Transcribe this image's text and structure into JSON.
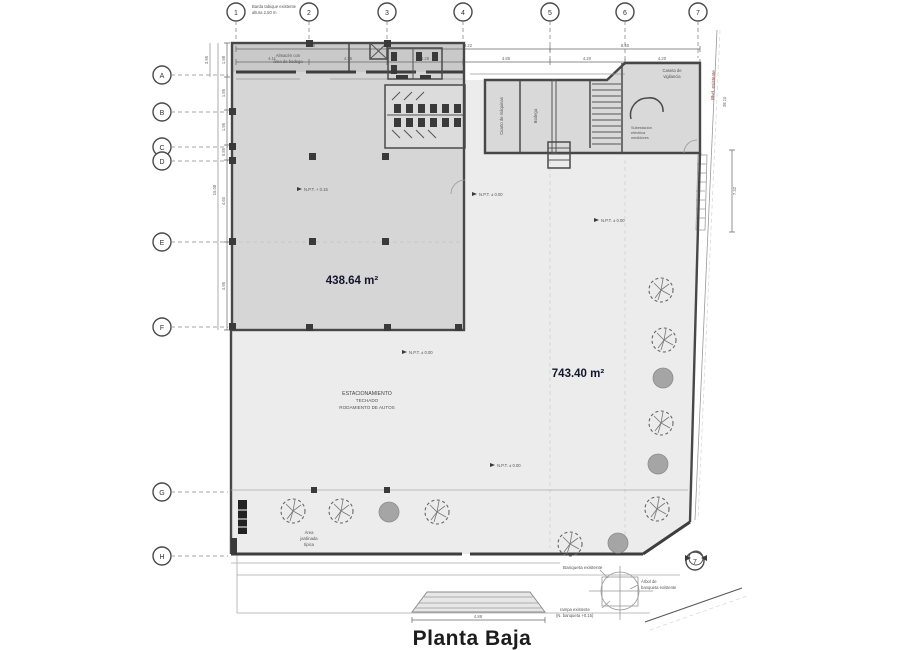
{
  "title": "Planta Baja",
  "areas": {
    "hall": "438.64 m²",
    "yard": "743.40 m²"
  },
  "labels": {
    "storage_note": [
      "Almacén con",
      "área de bodega"
    ],
    "parking": [
      "ESTACIONAMIENTO",
      "TECHADO",
      "RODAMIENTO DE AUTOS"
    ],
    "garden": [
      "Área",
      "jardinada",
      "típica"
    ],
    "room1": "Cuarto de máquinas",
    "room2": "Bodega",
    "guard": [
      "Caseta de",
      "vigilancia"
    ],
    "substation": [
      "Subestación",
      "eléctrica",
      "medidores"
    ],
    "sidewalk": "Banqueta existente",
    "tree_note": [
      "Árbol de",
      "banqueta existente"
    ],
    "ramp_note": [
      "rampa existente",
      "(N. banqueta +0.15)"
    ],
    "fence_note": [
      "Barda tabique existente",
      "altura 2.50 m"
    ],
    "street": "Blvd. existente",
    "npt_hall": "N.P.T. + 0.15",
    "npt_yard": "N.P.T. ± 0.00"
  },
  "grid": {
    "top": [
      "1",
      "2",
      "3",
      "4",
      "5",
      "6",
      "7"
    ],
    "left": [
      "A",
      "B",
      "C",
      "D",
      "E",
      "F",
      "G",
      "H"
    ],
    "corner": "7"
  },
  "dims": {
    "top_tier1": [
      "8.46",
      "9.22",
      "8.40"
    ],
    "top_tier2": [
      "4.11",
      "4.35",
      "4.28",
      "4.85",
      "4.20",
      "4.20"
    ],
    "left_inner": [
      "1.98",
      "1.85",
      "1.95",
      "0.85",
      "4.60",
      "4.95"
    ],
    "left_outer": "16.08",
    "left_top": "3.95",
    "right": "7.32",
    "right_len": "38.10",
    "ramp": "4.88"
  }
}
